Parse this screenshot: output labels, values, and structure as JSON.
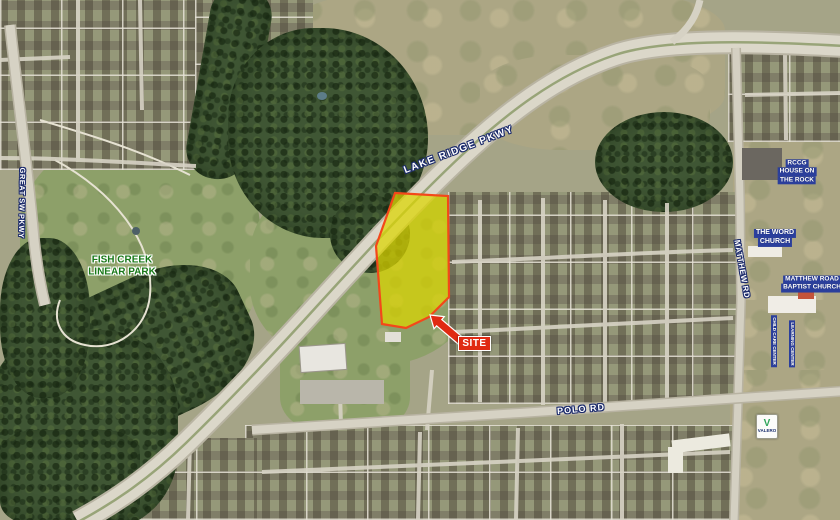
{
  "map": {
    "type": "aerial-site-annotation-map",
    "road_labels": {
      "great_sw_pkwy": "GREAT SW PKWY",
      "lake_ridge_pkwy": "LAKE RIDGE PKWY",
      "polo_rd": "POLO RD",
      "matthew_rd": "MATTHEW RD"
    },
    "park_label": {
      "line1": "FISH CREEK",
      "line2": "LINEAR PARK"
    },
    "site_callout": {
      "label": "SITE"
    },
    "poi_labels": {
      "rccg": [
        "RCCG",
        "HOUSE ON",
        "THE ROCK"
      ],
      "the_word_church": [
        "THE WORD",
        "CHURCH"
      ],
      "matthew_road_baptist": [
        "MATTHEW ROAD",
        "BAPTIST CHURCH"
      ],
      "childcare_left": "CHILD CARE CENTER",
      "childcare_right": "LEARNING CENTER",
      "valero": "VALERO"
    },
    "colors": {
      "site_fill": "#dcd500",
      "site_outline": "#f3481a",
      "callout_red": "#e02a12",
      "poi_blue": "#2b3f9c",
      "park_green": "#187818",
      "road_label_outline": "#1b2a6b"
    }
  }
}
